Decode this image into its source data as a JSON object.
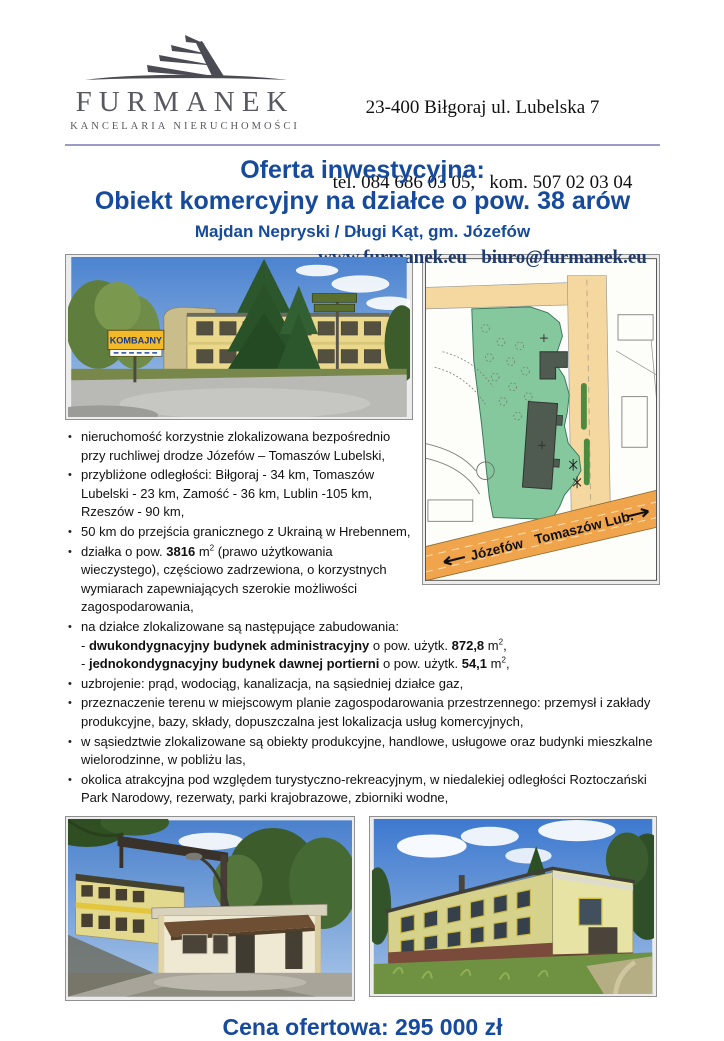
{
  "header": {
    "logo": {
      "name": "FURMANEK",
      "tagline": "KANCELARIA NIERUCHOMOŚCI"
    },
    "contact": {
      "address": "23-400 Biłgoraj ul. Lubelska 7",
      "phones": "tel. 084 686 03 05,   kom. 507 02 03 04",
      "web": "www.furmanek.eu   biuro@furmanek.eu"
    }
  },
  "title": {
    "line1": "Oferta inwestycyjna:",
    "line2": "Obiekt komercyjny na działce o pow. 38 arów",
    "subtitle": "Majdan Nepryski / Długi Kąt, gm. Józefów"
  },
  "photos": {
    "top": {
      "sign_text": "KOMBAJNY"
    }
  },
  "map": {
    "label_left": "Józefów",
    "label_right": "Tomaszów Lub."
  },
  "bullets": [
    [
      {
        "t": "nieruchomość korzystnie zlokalizowana bezpośrednio przy ruchliwej drodze Józefów – Tomaszów Lubelski,"
      }
    ],
    [
      {
        "t": "przybliżone odległości: Biłgoraj - 34 km, Tomaszów Lubelski - 23 km, Zamość - 36 km, Lublin -105 km, Rzeszów - 90 km,"
      }
    ],
    [
      {
        "t": "50 km do przejścia granicznego z Ukrainą w Hrebennem,"
      }
    ],
    [
      {
        "t": "działka o pow. "
      },
      {
        "t": "3816",
        "b": true
      },
      {
        "t": " m"
      },
      {
        "t": "2",
        "sup": true
      },
      {
        "t": " (prawo użytkowania wieczystego), częściowo zadrzewiona, o korzystnych wymiarach zapewniających szerokie możliwości zagospodarowania,"
      }
    ],
    [
      {
        "t": "na działce zlokalizowane są następujące zabudowania:"
      },
      {
        "br": true
      },
      {
        "t": "- "
      },
      {
        "t": "dwukondygnacyjny budynek administracyjny",
        "b": true
      },
      {
        "t": " o pow. użytk. "
      },
      {
        "t": "872,8",
        "b": true
      },
      {
        "t": " m"
      },
      {
        "t": "2",
        "sup": true
      },
      {
        "t": ","
      },
      {
        "br": true
      },
      {
        "t": "- "
      },
      {
        "t": "jednokondygnacyjny budynek dawnej portierni",
        "b": true
      },
      {
        "t": " o pow. użytk. "
      },
      {
        "t": "54,1",
        "b": true
      },
      {
        "t": " m"
      },
      {
        "t": "2",
        "sup": true
      },
      {
        "t": ","
      }
    ],
    [
      {
        "t": "uzbrojenie: prąd, wodociąg, kanalizacja, na sąsiedniej działce gaz,"
      }
    ],
    [
      {
        "t": "przeznaczenie terenu w miejscowym planie zagospodarowania przestrzennego: przemysł i zakłady produkcyjne, bazy, składy, dopuszczalna jest lokalizacja usług komercyjnych,"
      }
    ],
    [
      {
        "t": "w sąsiedztwie zlokalizowane są obiekty produkcyjne, handlowe, usługowe oraz budynki mieszkalne wielorodzinne, w pobliżu las,"
      }
    ],
    [
      {
        "t": "okolica atrakcyjna pod względem turystyczno-rekreacyjnym, w niedalekiej odległości Roztoczański Park Narodowy, rezerwaty, parki krajobrazowe, zbiorniki wodne,"
      }
    ]
  ],
  "price": {
    "label": "Cena ofertowa: 295 000 zł"
  },
  "colors": {
    "accent": "#164a9c",
    "rule": "#9a9bc9",
    "web_link": "#1f3a6e"
  }
}
